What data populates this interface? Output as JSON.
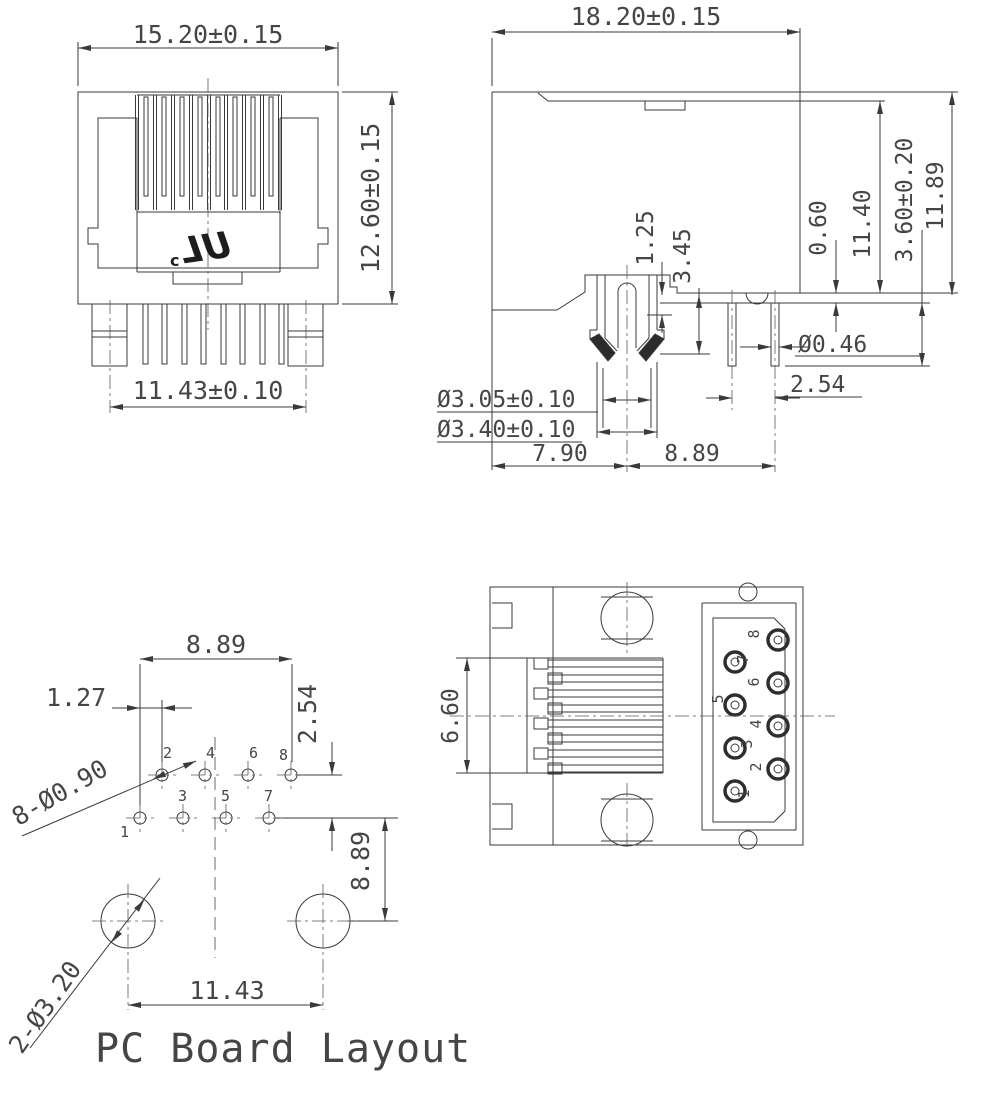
{
  "drawing": {
    "pin_numbers": [
      "1",
      "2",
      "3",
      "4",
      "5",
      "6",
      "7",
      "8"
    ],
    "front_view": {
      "width_dim": "15.20±0.15",
      "height_dim": "12.60±0.15",
      "pin_span_dim": "11.43±0.10",
      "ul_c": "c",
      "ul_mark": "UL"
    },
    "side_view": {
      "width_dim": "18.20±0.15",
      "latch_gap_dim": "1.25",
      "latch_depth_dim": "3.45",
      "standoff_dim": "0.60",
      "body_height_dim": "11.40",
      "pin_length_dim": "3.60±0.20",
      "overall_height_dim": "11.89",
      "post_inner_dia_dim": "Ø3.05±0.10",
      "post_outer_dia_dim": "Ø3.40±0.10",
      "pin_dia_dim": "Ø0.46",
      "pin_pitch_dim": "2.54",
      "post_offset_dim": "7.90",
      "pin_offset_dim": "8.89"
    },
    "pcb_layout": {
      "caption": "PC Board Layout",
      "row_span_dim": "8.89",
      "col_offset_dim": "1.27",
      "row_pitch_dim": "2.54",
      "mount_offset_dim": "8.89",
      "mount_span_dim": "11.43",
      "pin_holes_label": "8-Ø0.90",
      "mount_holes_label": "2-Ø3.20"
    },
    "bottom_view": {
      "contact_span_dim": "6.60"
    }
  }
}
